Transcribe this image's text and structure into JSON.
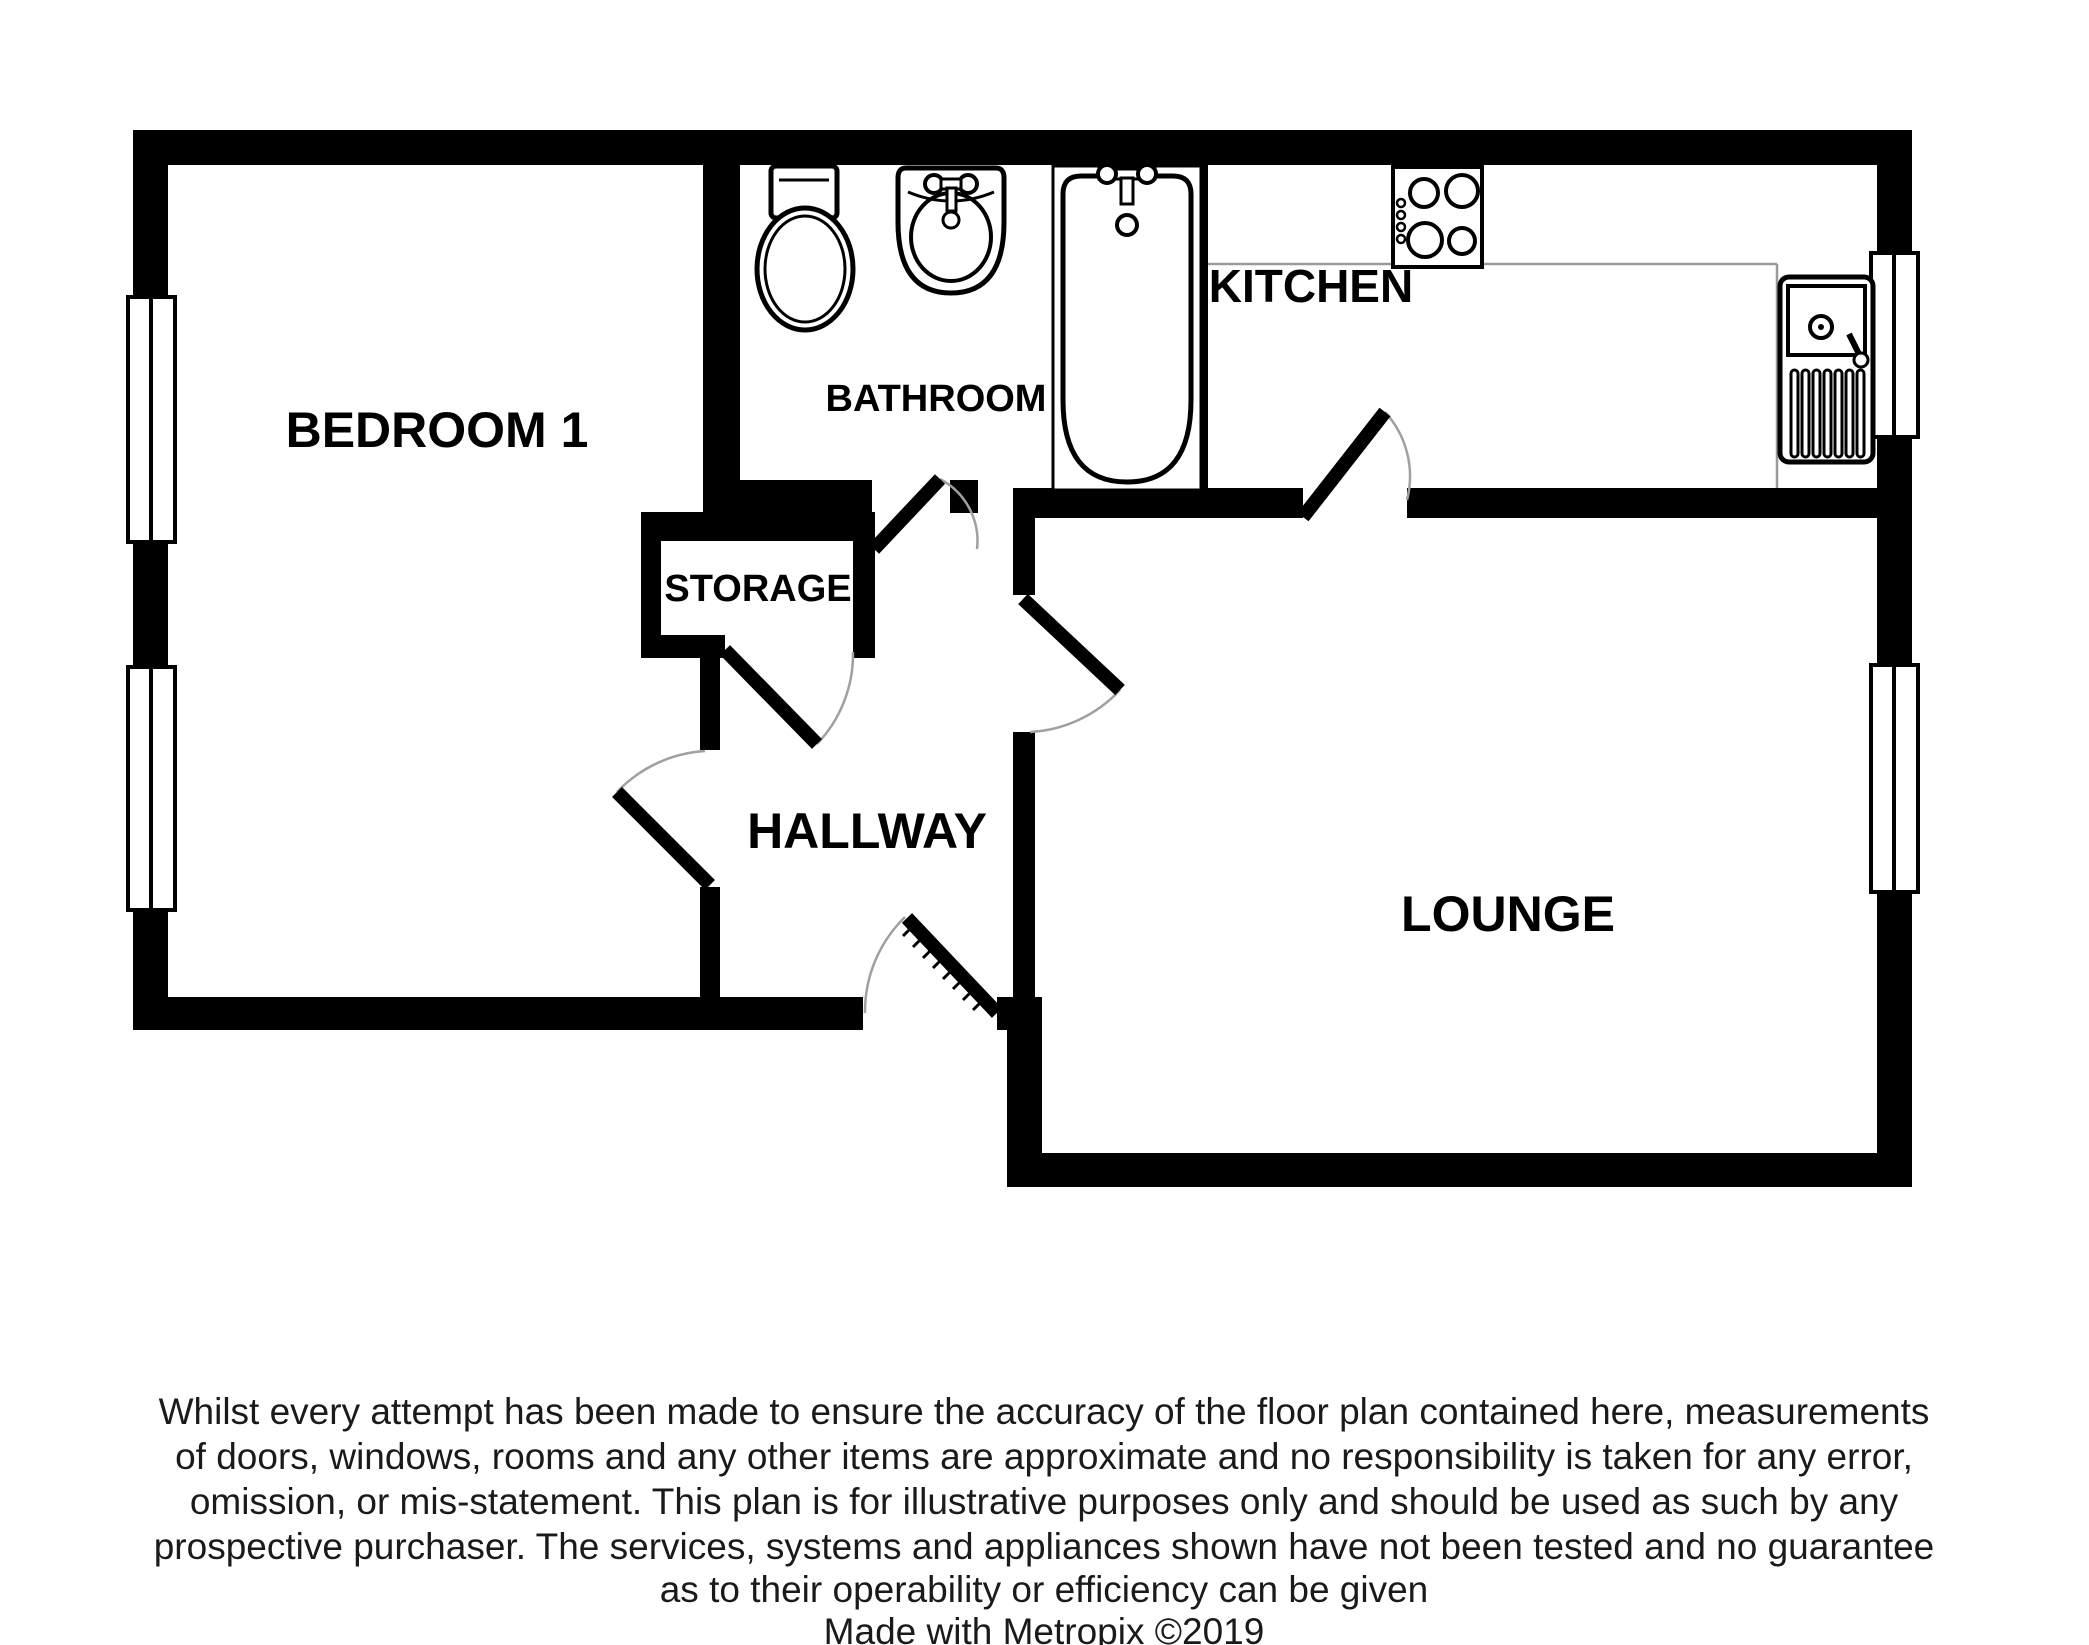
{
  "title": "Metropix floor plan",
  "rooms": {
    "bedroom": {
      "label": "BEDROOM 1"
    },
    "bathroom": {
      "label": "BATHROOM"
    },
    "kitchen": {
      "label": "KITCHEN"
    },
    "storage": {
      "label": "STORAGE"
    },
    "hallway": {
      "label": "HALLWAY"
    },
    "lounge": {
      "label": "LOUNGE"
    }
  },
  "fixtures": {
    "toilet": "toilet",
    "basin": "wash-basin",
    "bathtub": "bathtub",
    "hob": "cooker-hob-4-burners",
    "sink": "kitchen-sink-with-drainer"
  },
  "counts": {
    "windows": 4,
    "doors": 6
  },
  "disclaimer": {
    "lines": [
      "Whilst every attempt has been made to ensure the accuracy of the floor plan contained here, measurements",
      "of doors, windows, rooms and any other items are approximate and no responsibility is taken for any error,",
      "omission, or mis-statement. This plan is for illustrative purposes only and should be used as such by any",
      "prospective purchaser. The services, systems and appliances shown have not been tested and no guarantee",
      "as to their operability or efficiency can be given"
    ]
  },
  "footer": {
    "credit": "Made with Metropix ©2019"
  },
  "colors": {
    "wall": "#000000",
    "background": "#ffffff",
    "door_arc": "#a0a0a0",
    "counter_line": "#9a9a9a"
  }
}
